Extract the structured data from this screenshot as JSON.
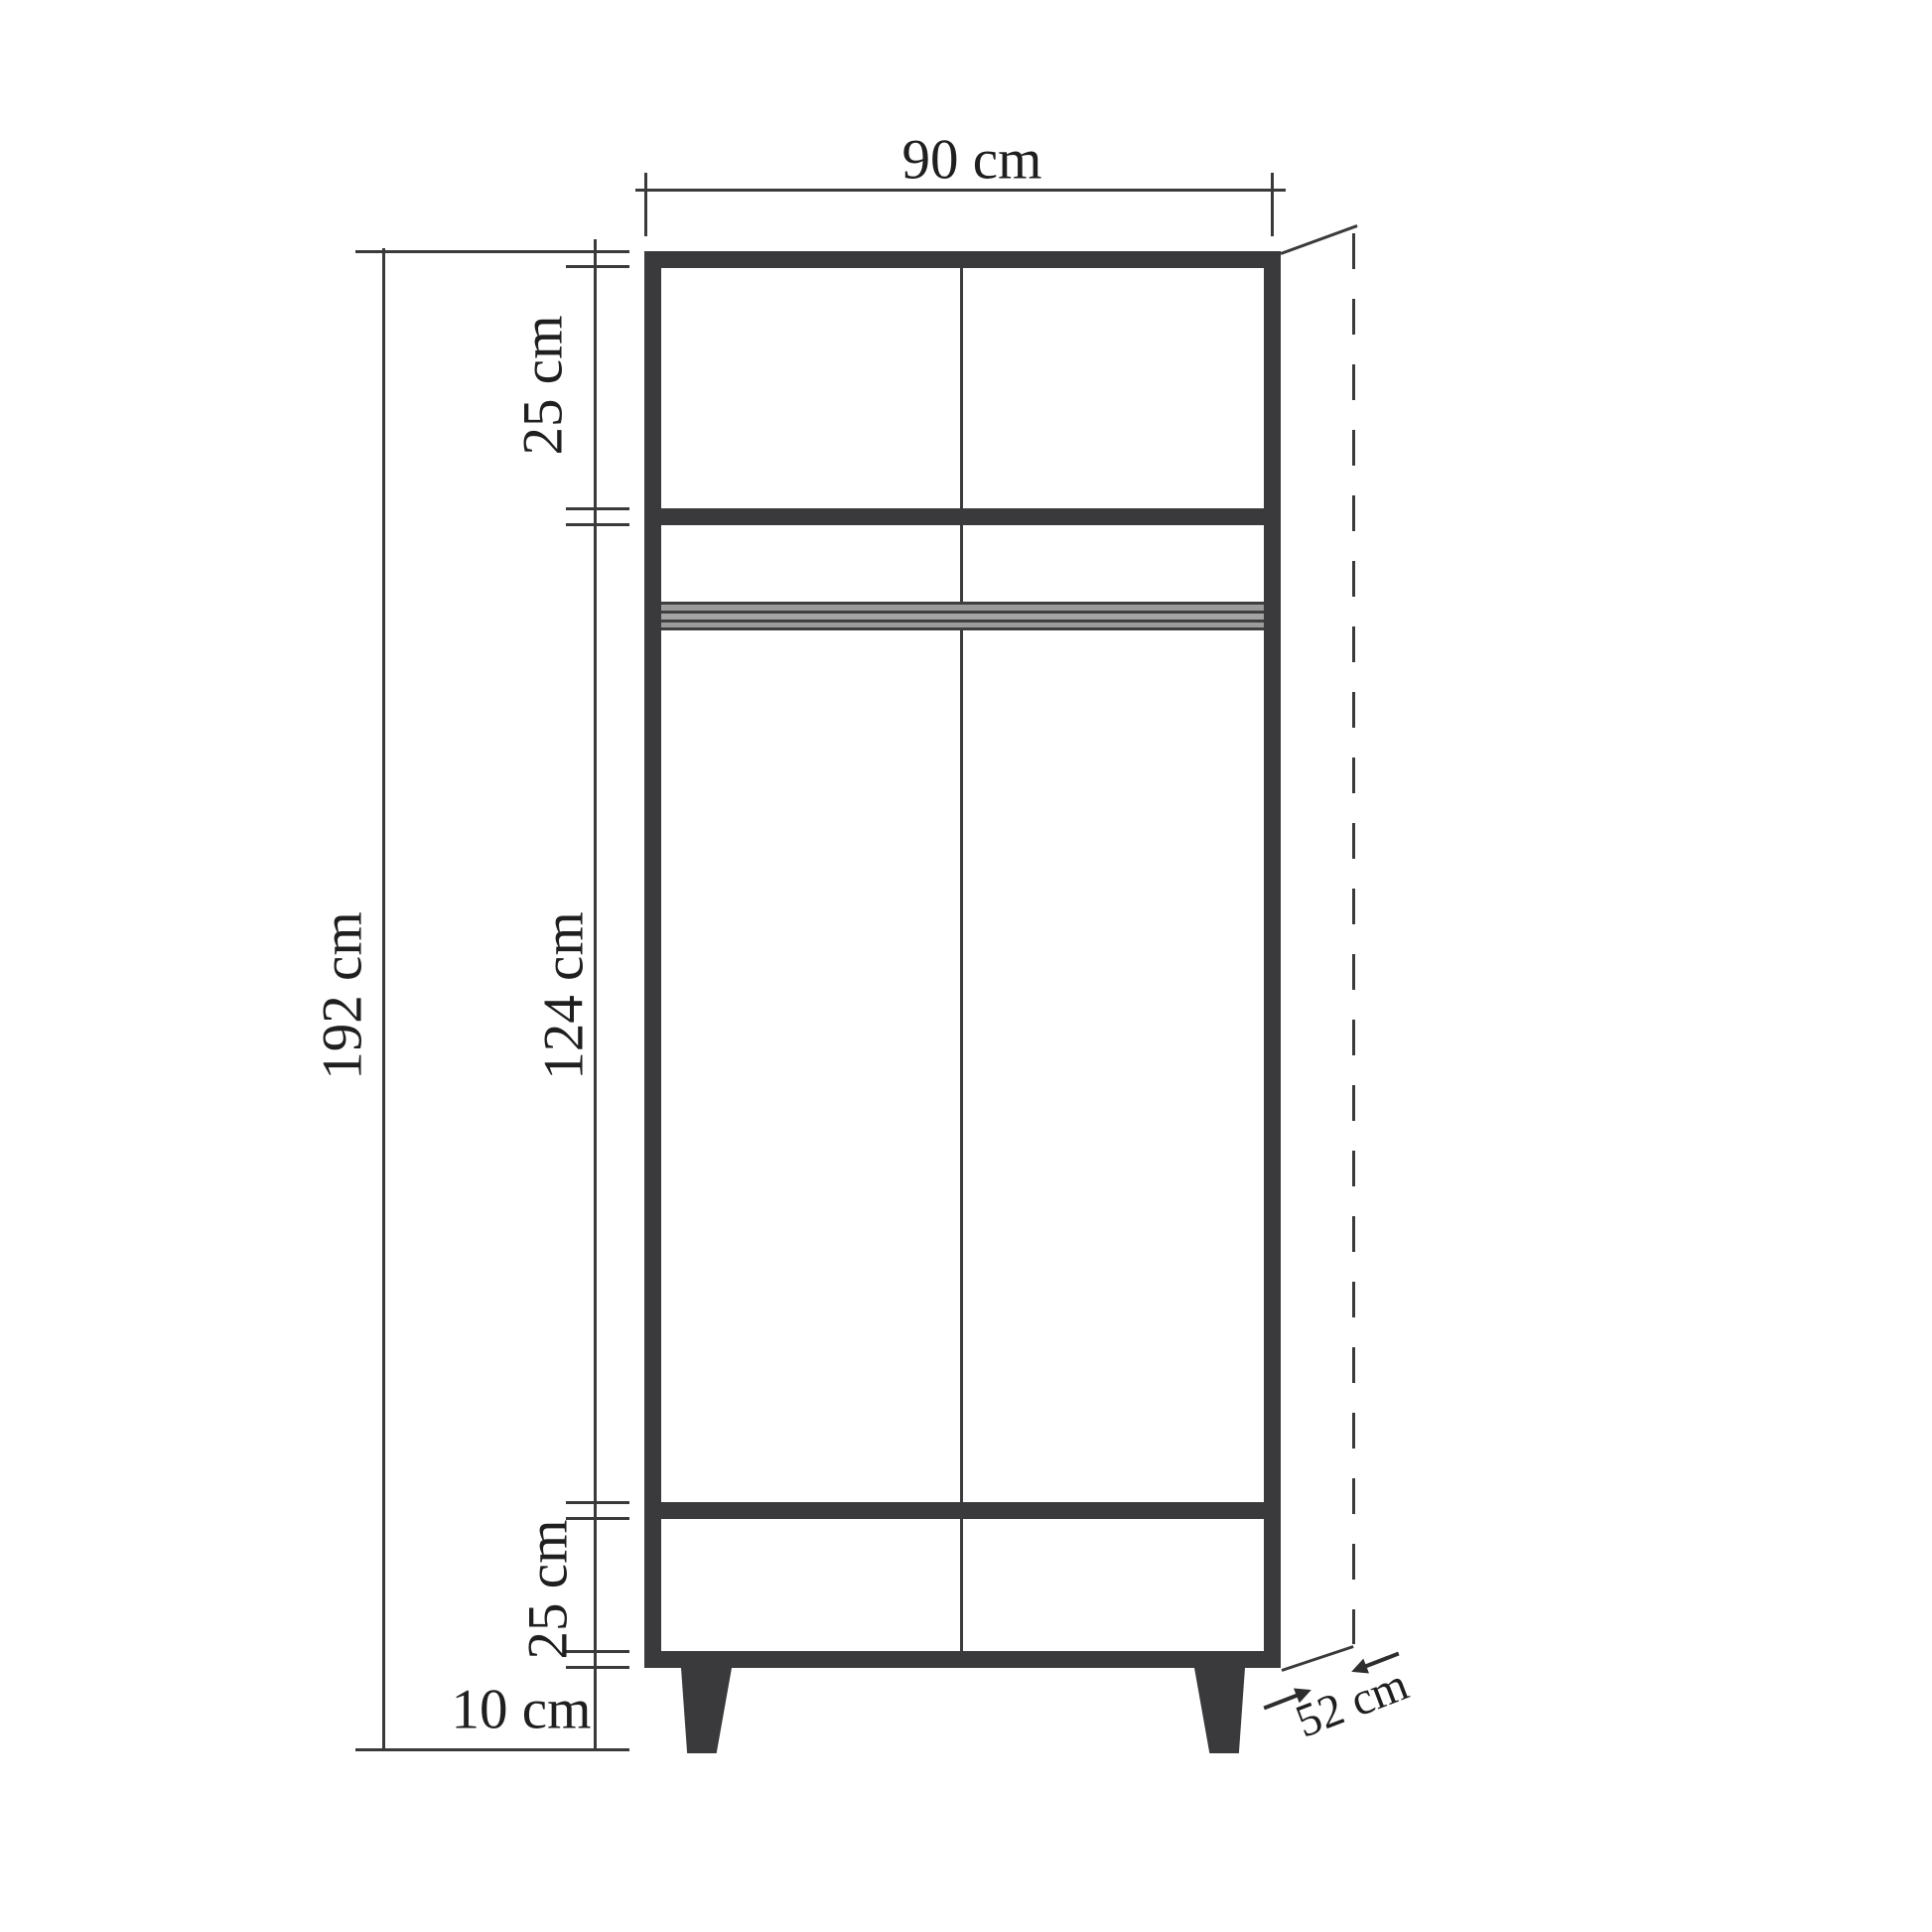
{
  "diagram": {
    "type": "furniture dimension drawing",
    "subject": "two-door wardrobe, front elevation with depth projection",
    "unit": "cm",
    "colors": {
      "line": "#3a3a3c",
      "rail": "#9b9b9b",
      "text": "#1f1f1f",
      "background": "#ffffff"
    },
    "labels": {
      "width": "90 cm",
      "total_height": "192 cm",
      "top_section_height": "25 cm",
      "door_section_height": "124 cm",
      "bottom_section_height": "25 cm",
      "leg_height": "10 cm",
      "depth": "52 cm"
    }
  }
}
